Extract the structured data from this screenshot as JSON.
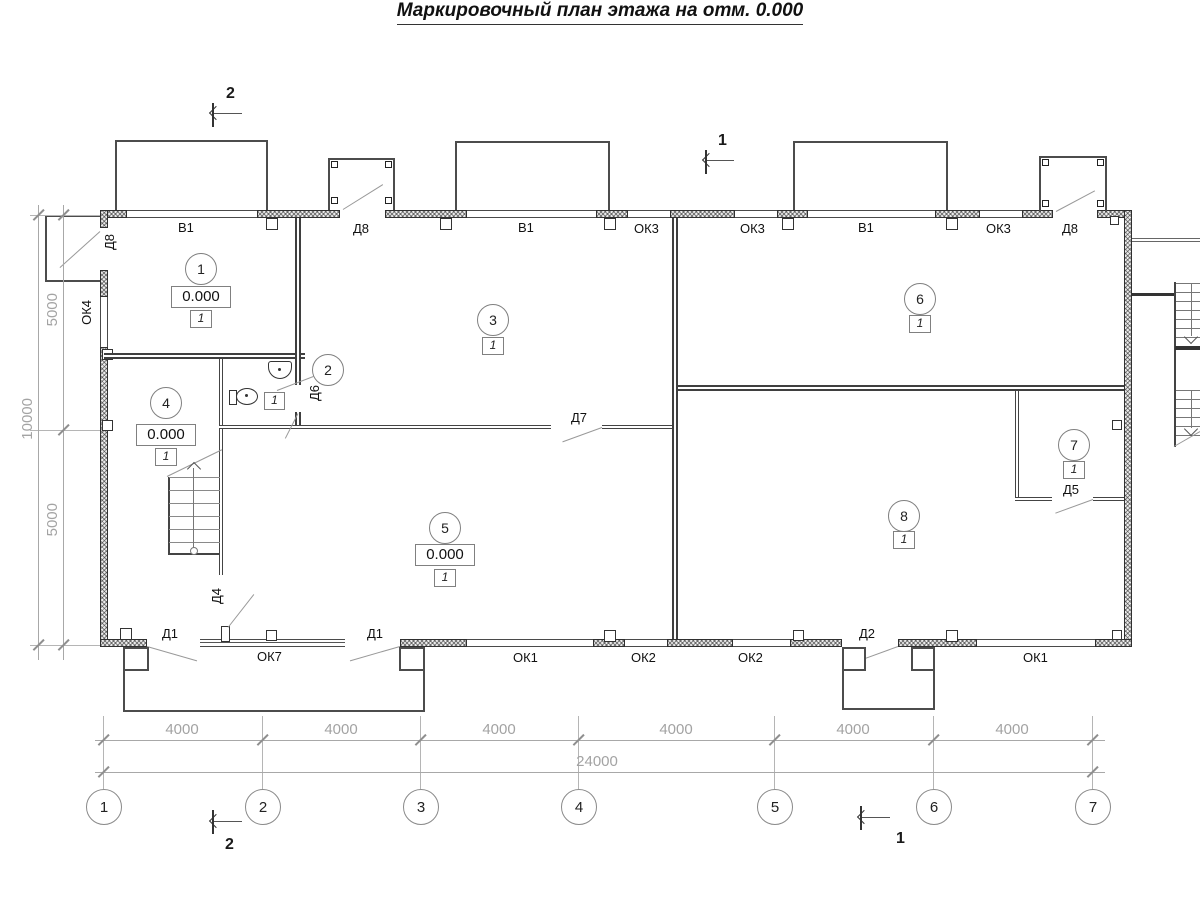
{
  "title": "Маркировочный план этажа на отм. 0.000",
  "rooms": {
    "r1": {
      "num": "1",
      "elev": "0.000",
      "type": "1"
    },
    "r2": {
      "num": "2",
      "type": "1"
    },
    "r3": {
      "num": "3",
      "type": "1"
    },
    "r4": {
      "num": "4",
      "elev": "0.000",
      "type": "1"
    },
    "r5": {
      "num": "5",
      "elev": "0.000",
      "type": "1"
    },
    "r6": {
      "num": "6",
      "type": "1"
    },
    "r7": {
      "num": "7",
      "type": "1"
    },
    "r8": {
      "num": "8",
      "type": "1"
    }
  },
  "openings": {
    "v1": "В1",
    "ok1": "ОК1",
    "ok2": "ОК2",
    "ok3": "ОК3",
    "ok4": "ОК4",
    "ok7": "ОК7",
    "d1": "Д1",
    "d2": "Д2",
    "d4": "Д4",
    "d5": "Д5",
    "d6": "Д6",
    "d7": "Д7",
    "d8": "Д8"
  },
  "axes": [
    "1",
    "2",
    "3",
    "4",
    "5",
    "6",
    "7"
  ],
  "dims": {
    "bays": [
      "4000",
      "4000",
      "4000",
      "4000",
      "4000",
      "4000"
    ],
    "total": "24000",
    "left_bays": [
      "5000",
      "5000"
    ],
    "left_total": "10000"
  },
  "sections": {
    "one": "1",
    "two": "2"
  },
  "colors": {
    "line_dark": "#2f2f2f",
    "line_gray": "#8a8a8a",
    "dim_gray": "#a3a3a3",
    "paper": "#ffffff"
  }
}
